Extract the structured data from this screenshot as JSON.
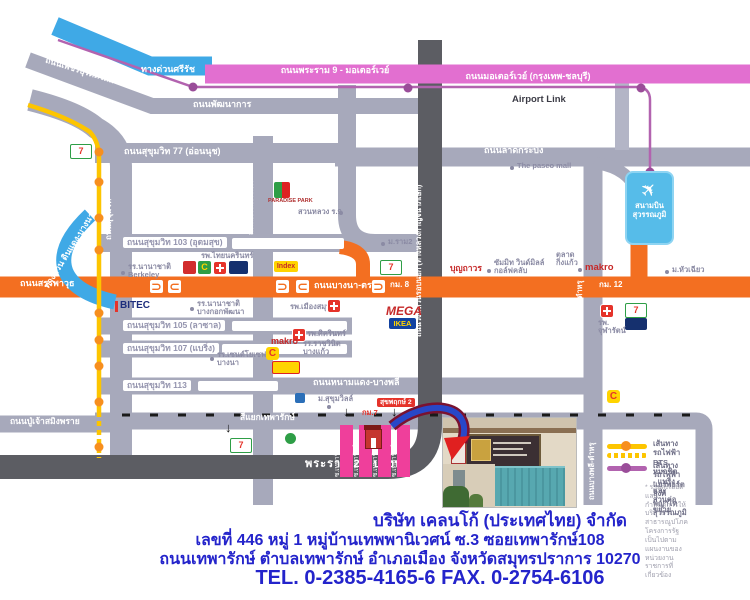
{
  "colors": {
    "road_gray": "#a7a9bb",
    "road_dark": "#5c5d63",
    "road_orange": "#f36f21",
    "motorway_pink": "#e26fd0",
    "expressway_blue": "#3fa9e6",
    "bts_yellow": "#fdc500",
    "bts_dot_orange": "#f78f1e",
    "airportlink_purple": "#b263af",
    "soi_pink": "#ef3f9b",
    "company_text_blue": "#2424cb",
    "landmark_gray": "#8b8ba4",
    "highlight_red": "#e5332a"
  },
  "icons": {
    "uturn_left": "⊃",
    "uturn_right": "⊂",
    "down_arrow": "↓",
    "plane": "✈",
    "bigc_c": "C",
    "seven": "7",
    "asterisk": "*"
  },
  "roads": {
    "srirat_expwy": "ทางด่วนศรีรัช",
    "rama9_motorway": "ถนนพระราม 9 - มอเตอร์เวย์",
    "motorway_bkk_chonburi": "ถนนมอเตอร์เวย์ (กรุงเทพ-ชลบุรี)",
    "airport_link": "Airport Link",
    "phetchaburi": "ถนนเพชรบุรีตัดใหม่",
    "phatthanakan": "ถนนพัฒนาการ",
    "sukhumvit77": "ถนนสุขุมวิท 77 (อ่อนนุช)",
    "sukhumvit": "ถนนสุขุมวิท",
    "srinagarindra": "ถนนศรีนครินทร์",
    "lat_krabang": "ถนนลาดกระบัง",
    "outer_ring": "ถนนวงแหวนรอบนอก (ทางหลวงกาญจนาภิเษก)",
    "dindaeng_bangna_expwy": "ทางด่วน ดินแดง-บางนา",
    "sanphawut": "ถนนสรรพาวุธ",
    "bangna_trad": "ถนนบางนา-ตราด",
    "sukhumvit103": "ถนนสุขุมวิท 103 (อุดมสุข)",
    "sukhumvit105": "ถนนสุขุมวิท 105 (ลาซาล)",
    "sukhumvit107": "ถนนสุขุมวิท 107 (แบริ่ง)",
    "sukhumvit113": "ถนนสุขุมวิท 113",
    "namdaeng_bangphli": "ถนนหนามแดง-บางพลี",
    "pu_chao": "ถนนปู่เจ้าสมิงพราย",
    "thepharak_junction": "สี่แยกเทพารักษ์",
    "rama2_bangphli": "พระราม 2 - บางพลี",
    "king_kaew": "ถนนกิ่งแก้ว",
    "bangphli_tamru": "ถนนบางพลี-ตำหรุ",
    "km7": "กม.7",
    "km8": "กม. 8",
    "km12": "กม. 12"
  },
  "landmarks": {
    "paradise_park": "PARADISE PARK",
    "suan_luang": "สวนหลวง ร.9",
    "thai_nakarin": "รพ.ไทยนครินทร์",
    "intl_school": "รร.นานาชาติ",
    "berkeley": "Berkeley",
    "bitec": "BITEC",
    "bkk_patana": "บางกอกพัฒนา",
    "index": "Index",
    "muang_samut": "รพ.เมืองสมุทร",
    "mega": "MEGA",
    "ikea": "IKEA",
    "sikarin": "รพ.ศิครินทร์",
    "makro": "makro",
    "ratwinit1": "รร.ราชวินิต",
    "ratwinit2": "บางแก้ว",
    "concordian": "Concordian",
    "st_joseph1": "รร.เซนต์โยเซฟ",
    "st_joseph2": "บางนา",
    "ram2_univ": "ม.ราม2",
    "boonthavorn": "บุญถาวร",
    "summit1": "ซัมมิท วินด์มิลล์",
    "summit2": "กอล์ฟคลับ",
    "paseo": "The paseo mall",
    "airport1": "สนามบิน",
    "airport2": "สุวรรณภูมิ",
    "market1": "ตลาด",
    "market2": "กิ่งแก้ว",
    "huachiew": "ม.หัวเฉียว",
    "chularat1": "รพ.",
    "chularat2": "จุฬารัตน์",
    "sukrudee_village": "ม.สุขุมวิลล์",
    "sukphruek": "สุขพฤกษ์ 2",
    "soi104": "ซ.เทพารักษ์ 104",
    "soi106": "ซ.เทพารักษ์ 106",
    "soi108": "ซ.เทพารักษ์ 108",
    "soi110": "ซ.เทพารักษ์ 110"
  },
  "legend": {
    "bts_title": "เส้นทางรถไฟฟ้า BTS",
    "bts_detail": "หมอชิต - แบริ่ง และส่วนต่อขยาย",
    "arl_title": "เส้นทางรถไฟฟ้า",
    "arl_detail": "แอร์พอร์ตลิงค์ พญาไท สุวรรณภูมิ",
    "note1": "* รายละเอียดและกำหนดการให้บริการ",
    "note2": "สาธารณูปโภคโครงการรัฐ เป็นไปตาม",
    "note3": "แผนงานของหน่วยงานราชการที่เกี่ยวข้อง"
  },
  "company": {
    "name": "บริษัท เคลนโก้ (ประเทศไทย) จำกัด",
    "address1": "เลขที่ 446 หมู่ 1 หมู่บ้านเทพพานิเวศน์ ซ.3  ซอยเทพารักษ์108",
    "address2": "ถนนเทพารักษ์ ตำบลเทพารักษ์ อำเภอเมือง จังหวัดสมุทรปราการ 10270",
    "phone": "TEL. 0-2385-4165-6  FAX. 0-2754-6106"
  }
}
